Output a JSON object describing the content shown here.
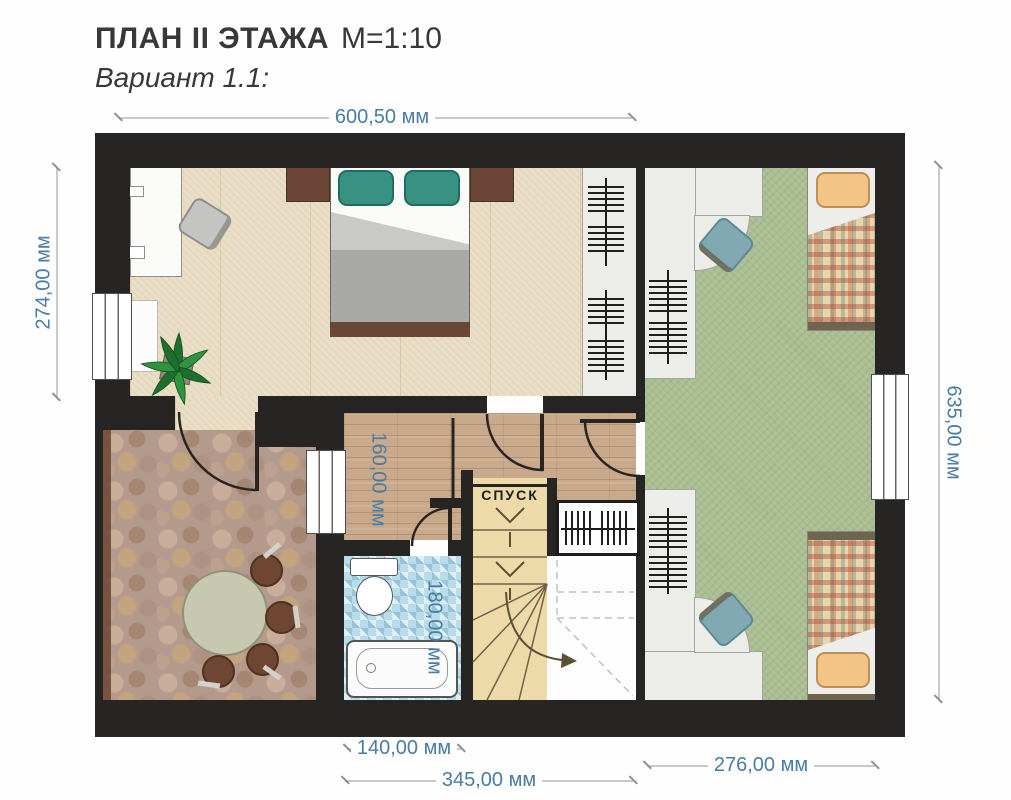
{
  "title": {
    "main": "ПЛАН II ЭТАЖА",
    "scale": "М=1:10",
    "variant": "Вариант 1.1:"
  },
  "stairs": {
    "label": "СПУСК"
  },
  "dimensions": {
    "top": "600,50 мм",
    "left": "274,00 мм",
    "right": "635,00 мм",
    "hall_width": "160,00 мм",
    "bath_width": "180,00 мм",
    "bottom_bath": "140,00 мм",
    "bottom_center": "345,00 мм",
    "bottom_right": "276,00 мм"
  },
  "colors": {
    "wall": "#272523",
    "dimension_text": "#4b7ca3",
    "bedroom_floor": "#e9dec6",
    "kids_room_floor": "#a9bd91",
    "hallway_floor": "#c9a98b",
    "dining_floor": "#b49a8c",
    "bathroom_floor": "#b7dcec",
    "stairs_floor": "#eedaa9",
    "pillow_teal": "#399181",
    "pillow_orange": "#f2c586",
    "table_top": "#c6c8b0",
    "chair_blue": "#81a9b4",
    "bed_wood": "#6b4636"
  }
}
